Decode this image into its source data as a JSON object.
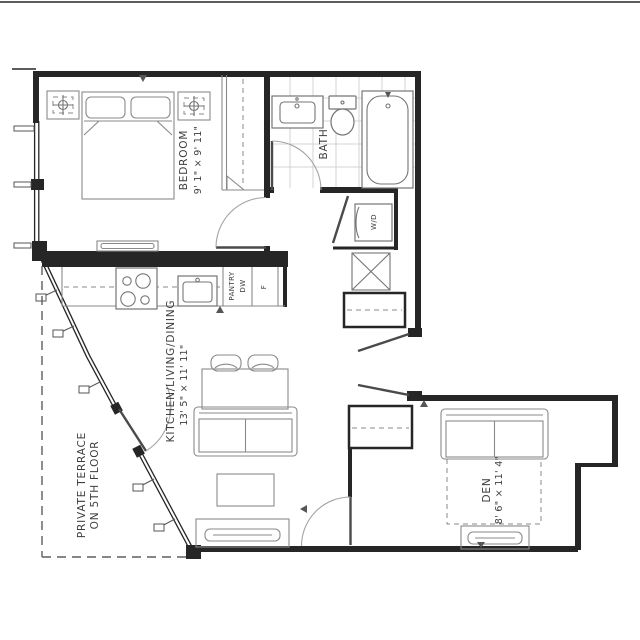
{
  "plan": {
    "title": "apartment-floor-plan",
    "rooms": {
      "bedroom": {
        "label": "BEDROOM",
        "dims": "9' 1\" × 9' 11\""
      },
      "bath": {
        "label": "BATH"
      },
      "kitchen_living_dining": {
        "label": "KITCHEN/LIVING/DINING",
        "dims": "13' 5\" × 11' 11\""
      },
      "den": {
        "label": "DEN",
        "dims": "8' 6\" × 11' 4\""
      },
      "terrace": {
        "label_line1": "PRIVATE TERRACE",
        "label_line2": "ON 5TH FLOOR"
      }
    },
    "appliances": {
      "pantry": "PANTRY",
      "dishwasher": "DW",
      "fridge": "F",
      "washer_dryer": "W/D"
    },
    "colors": {
      "wall": "#262626",
      "furniture": "#8a8a8a",
      "fixture": "#757575",
      "tile": "#c9c9c9",
      "text": "#3d3d3d",
      "dashed": "#5f5f5f"
    }
  }
}
